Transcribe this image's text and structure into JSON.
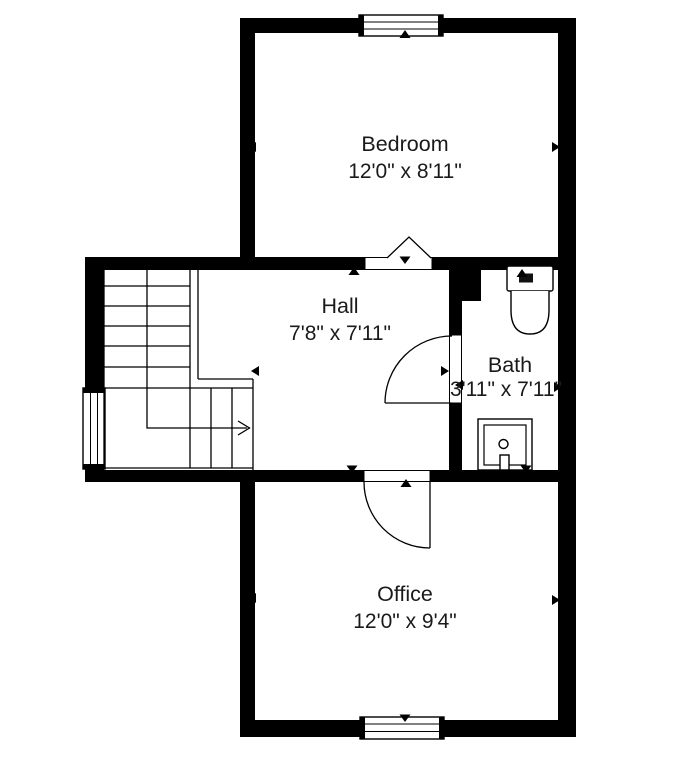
{
  "plan": {
    "type": "floor-plan",
    "background_color": "#ffffff",
    "wall_color": "#000000",
    "line_color": "#000000",
    "text_color": "#1a1a1a",
    "rooms": [
      {
        "id": "bedroom",
        "name": "Bedroom",
        "dimensions": "12'0\" x 8'11\""
      },
      {
        "id": "hall",
        "name": "Hall",
        "dimensions": "7'8\" x 7'11\""
      },
      {
        "id": "bath",
        "name": "Bath",
        "dimensions": "3'11\" x 7'11\""
      },
      {
        "id": "office",
        "name": "Office",
        "dimensions": "12'0\" x 9'4\""
      }
    ],
    "fixtures": [
      "staircase-with-direction-arrow",
      "toilet",
      "sink"
    ],
    "windows_count": 3,
    "door_symbols": [
      "swing-door-hall-bath",
      "swing-door-hall-office",
      "folding-door-bedroom"
    ],
    "dimension_arrow_style": "small filled triangles pointing at walls"
  }
}
